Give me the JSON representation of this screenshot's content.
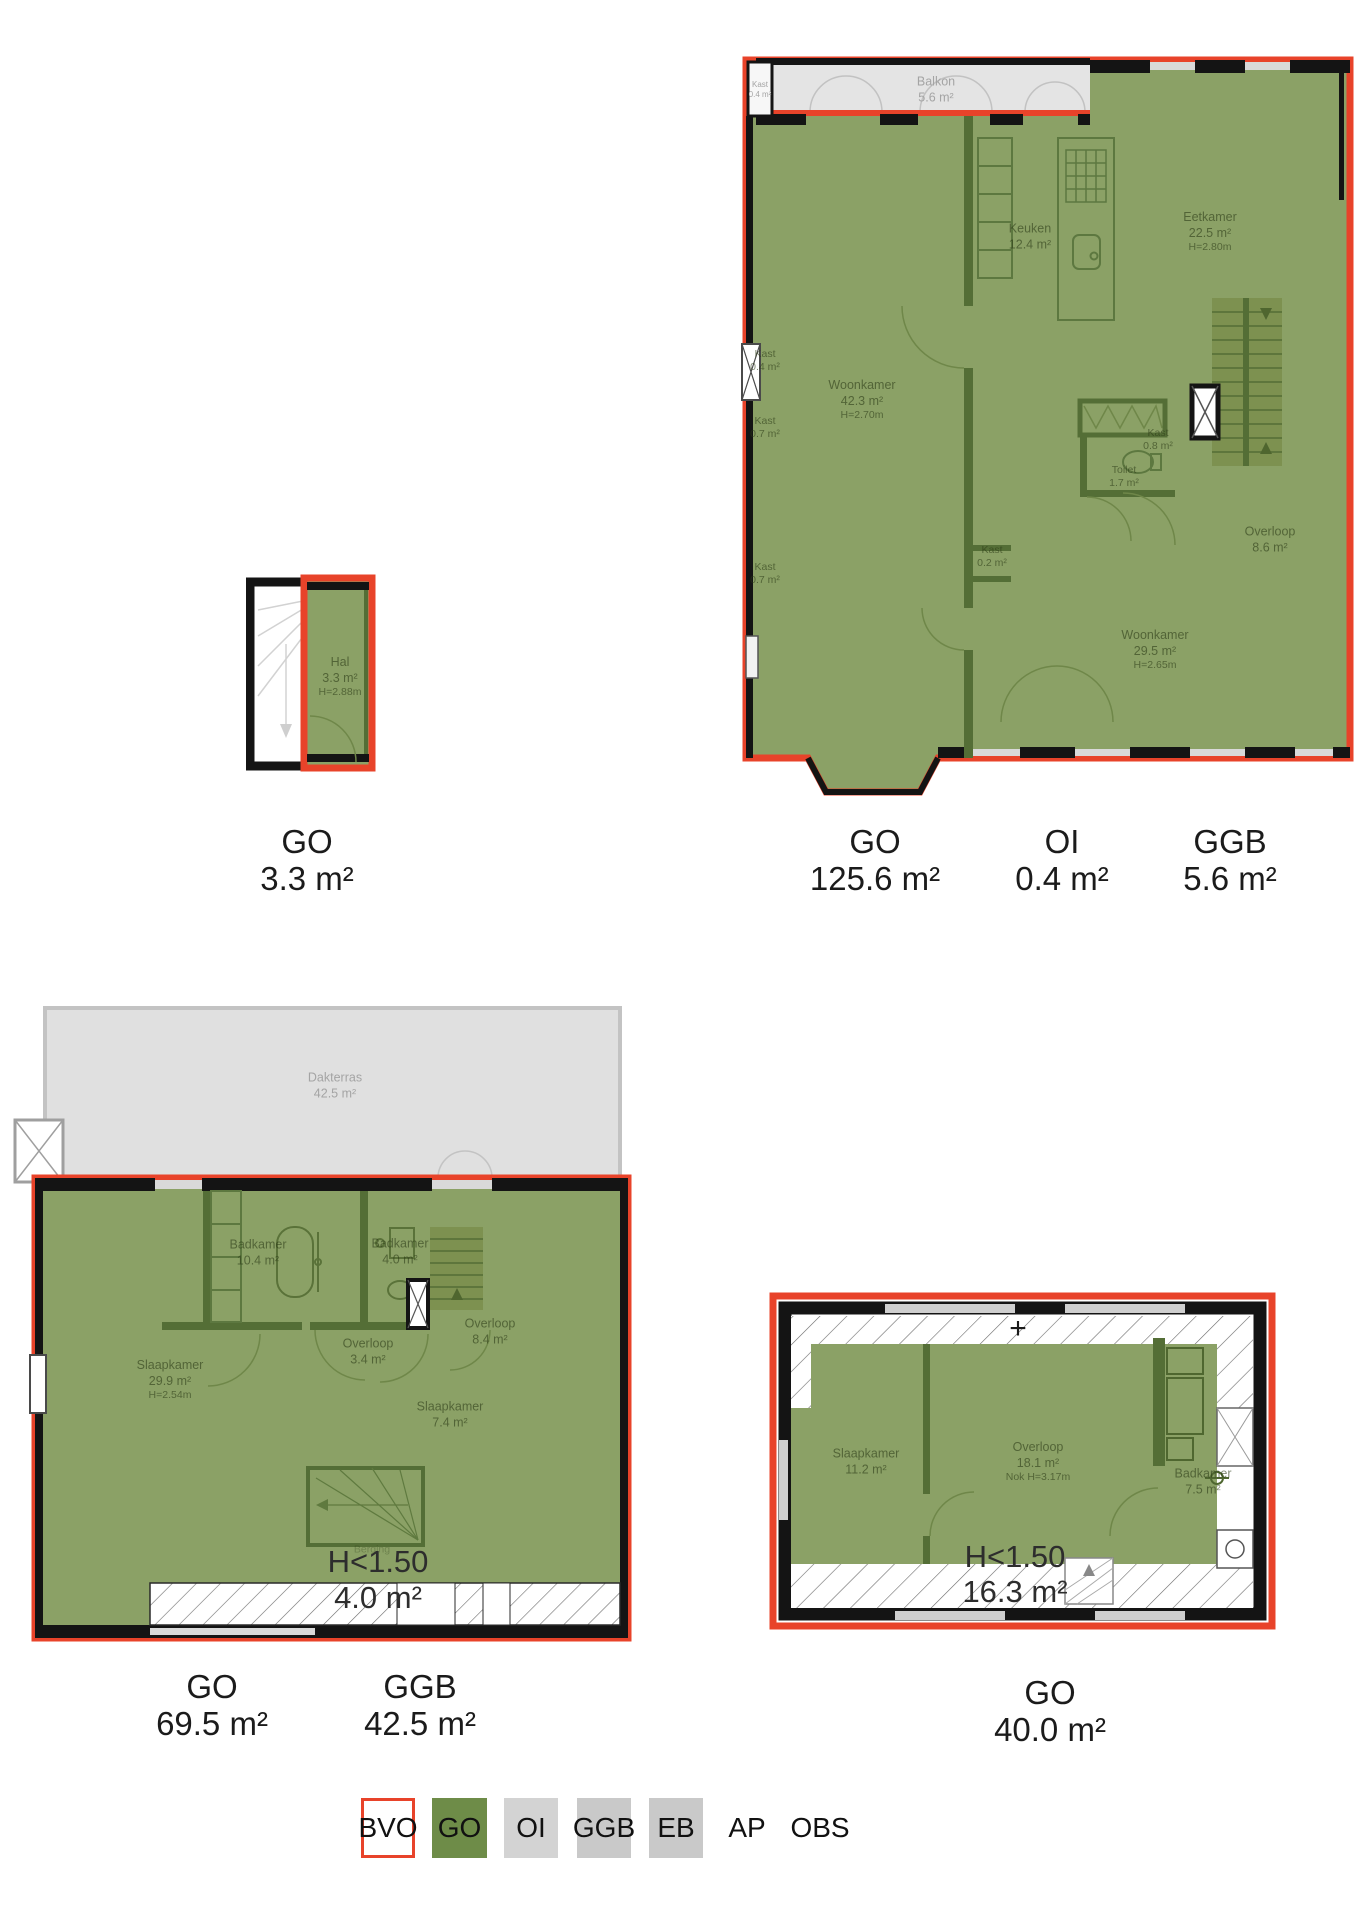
{
  "colors": {
    "bvo_red": "#e8432a",
    "go_green": "#6e8c48",
    "room_fill_green": "#8ba166",
    "wall_dark_green": "#546e36",
    "wall_black": "#141414",
    "terrace_gray": "#e0e0e0",
    "legend_gray": "#c9c9c9",
    "legend_gray_light": "#d3d3d3"
  },
  "plans": {
    "hal": {
      "rooms": {
        "hal": {
          "name": "Hal",
          "area": "3.3 m²",
          "height": "H=2.88m"
        }
      },
      "totals": {
        "go": {
          "code": "GO",
          "area": "3.3 m²"
        }
      }
    },
    "first_floor": {
      "rooms": {
        "balkon": {
          "name": "Balkon",
          "area": "5.6 m²"
        },
        "kast_balkon": {
          "name": "Kast",
          "area": "0.4 m²"
        },
        "keuken": {
          "name": "Keuken",
          "area": "12.4 m²"
        },
        "eetkamer": {
          "name": "Eetkamer",
          "area": "22.5 m²",
          "height": "H=2.80m"
        },
        "woonkamer_voor": {
          "name": "Woonkamer",
          "area": "42.3 m²",
          "height": "H=2.70m"
        },
        "kast_links_1": {
          "name": "Kast",
          "area": "0.4 m²"
        },
        "kast_links_2": {
          "name": "Kast",
          "area": "0.7 m²"
        },
        "kast_links_3": {
          "name": "Kast",
          "area": "0.7 m²"
        },
        "kast_midden": {
          "name": "Kast",
          "area": "0.2 m²"
        },
        "kast_trap": {
          "name": "Kast",
          "area": "0.8 m²"
        },
        "toilet": {
          "name": "Toilet",
          "area": "1.7 m²"
        },
        "overloop": {
          "name": "Overloop",
          "area": "8.6 m²"
        },
        "woonkamer_achter": {
          "name": "Woonkamer",
          "area": "29.5 m²",
          "height": "H=2.65m"
        }
      },
      "totals": {
        "go": {
          "code": "GO",
          "area": "125.6 m²"
        },
        "oi": {
          "code": "OI",
          "area": "0.4 m²"
        },
        "ggb": {
          "code": "GGB",
          "area": "5.6 m²"
        }
      }
    },
    "second_floor": {
      "rooms": {
        "dakterras": {
          "name": "Dakterras",
          "area": "42.5 m²"
        },
        "badkamer_groot": {
          "name": "Badkamer",
          "area": "10.4 m²"
        },
        "badkamer_klein": {
          "name": "Badkamer",
          "area": "4.0 m²"
        },
        "slaapkamer_groot": {
          "name": "Slaapkamer",
          "area": "29.9 m²",
          "height": "H=2.54m"
        },
        "overloop_klein": {
          "name": "Overloop",
          "area": "3.4 m²"
        },
        "overloop_groot": {
          "name": "Overloop",
          "area": "8.4 m²"
        },
        "slaapkamer_klein": {
          "name": "Slaapkamer",
          "area": "7.4 m²"
        },
        "berging": {
          "name": "Berging"
        },
        "laag": {
          "label": "H<1.50",
          "area": "4.0 m²"
        }
      },
      "totals": {
        "go": {
          "code": "GO",
          "area": "69.5 m²"
        },
        "ggb": {
          "code": "GGB",
          "area": "42.5 m²"
        }
      }
    },
    "top_floor": {
      "plus_mark": "+",
      "rooms": {
        "slaapkamer": {
          "name": "Slaapkamer",
          "area": "11.2 m²"
        },
        "overloop": {
          "name": "Overloop",
          "area": "18.1 m²",
          "height": "Nok H=3.17m"
        },
        "badkamer": {
          "name": "Badkamer",
          "area": "7.5 m²"
        },
        "laag": {
          "label": "H<1.50",
          "area": "16.3 m²"
        }
      },
      "totals": {
        "go": {
          "code": "GO",
          "area": "40.0 m²"
        }
      }
    }
  },
  "legend": {
    "bvo": "BVO",
    "go": "GO",
    "oi": "OI",
    "ggb": "GGB",
    "eb": "EB",
    "ap": "AP",
    "obs": "OBS"
  }
}
